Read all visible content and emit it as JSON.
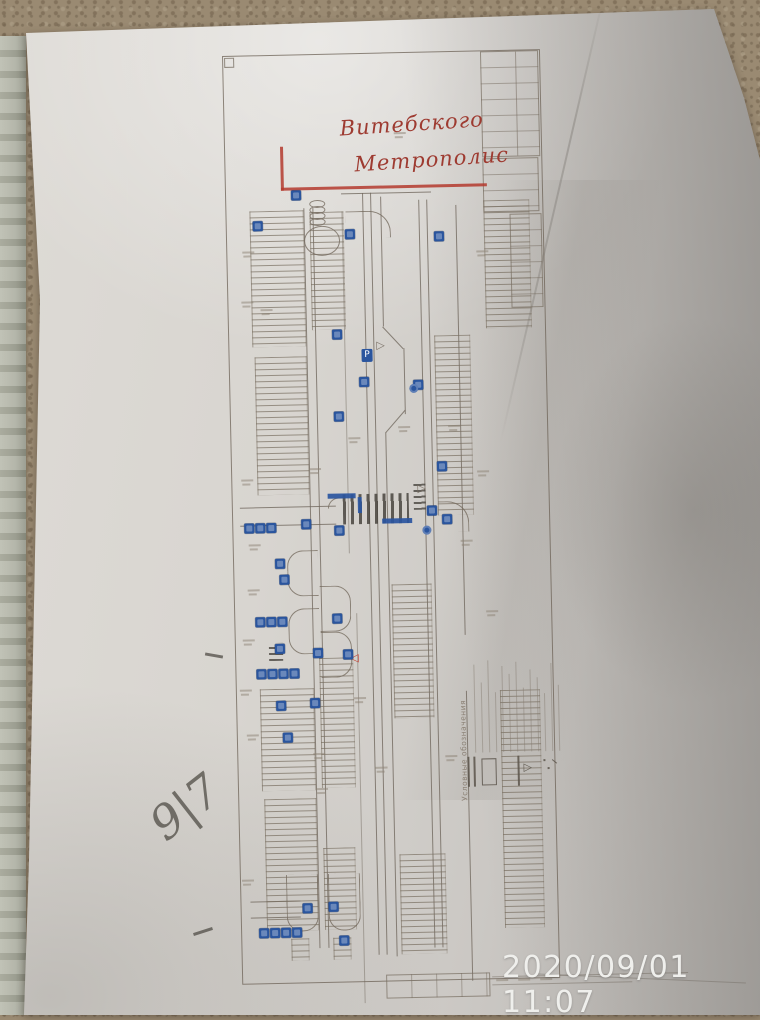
{
  "photo": {
    "timestamp": "2020/09/01 11:07"
  },
  "handwriting": {
    "line1": "Витебского",
    "line2": "Метрополис",
    "page_note": "9|7"
  },
  "drawing": {
    "legend_title": "Условные обозначения",
    "parking_sign_label": "P",
    "sign_color": "#2a559e",
    "annotation_color": "#b43a2e",
    "sign_markers": [
      [
        66,
        136
      ],
      [
        27,
        166
      ],
      [
        119,
        176
      ],
      [
        208,
        180
      ],
      [
        104,
        276
      ],
      [
        130,
        324
      ],
      [
        184,
        328
      ],
      [
        104,
        358
      ],
      [
        206,
        410
      ],
      [
        195,
        454
      ],
      [
        210,
        463
      ],
      [
        69,
        465
      ],
      [
        102,
        472
      ],
      [
        12,
        468
      ],
      [
        23,
        468
      ],
      [
        34,
        468
      ],
      [
        42,
        504
      ],
      [
        46,
        520
      ],
      [
        21,
        562
      ],
      [
        32,
        562
      ],
      [
        43,
        562
      ],
      [
        98,
        560
      ],
      [
        40,
        589
      ],
      [
        78,
        594
      ],
      [
        108,
        596
      ],
      [
        21,
        614
      ],
      [
        32,
        614
      ],
      [
        43,
        614
      ],
      [
        54,
        614
      ],
      [
        74,
        644
      ],
      [
        40,
        646
      ],
      [
        46,
        678
      ],
      [
        88,
        848
      ],
      [
        62,
        849
      ],
      [
        18,
        873
      ],
      [
        29,
        873
      ],
      [
        40,
        873
      ],
      [
        51,
        873
      ],
      [
        98,
        882
      ]
    ],
    "circle_markers": [
      [
        190,
        474
      ],
      [
        180,
        332
      ]
    ]
  }
}
